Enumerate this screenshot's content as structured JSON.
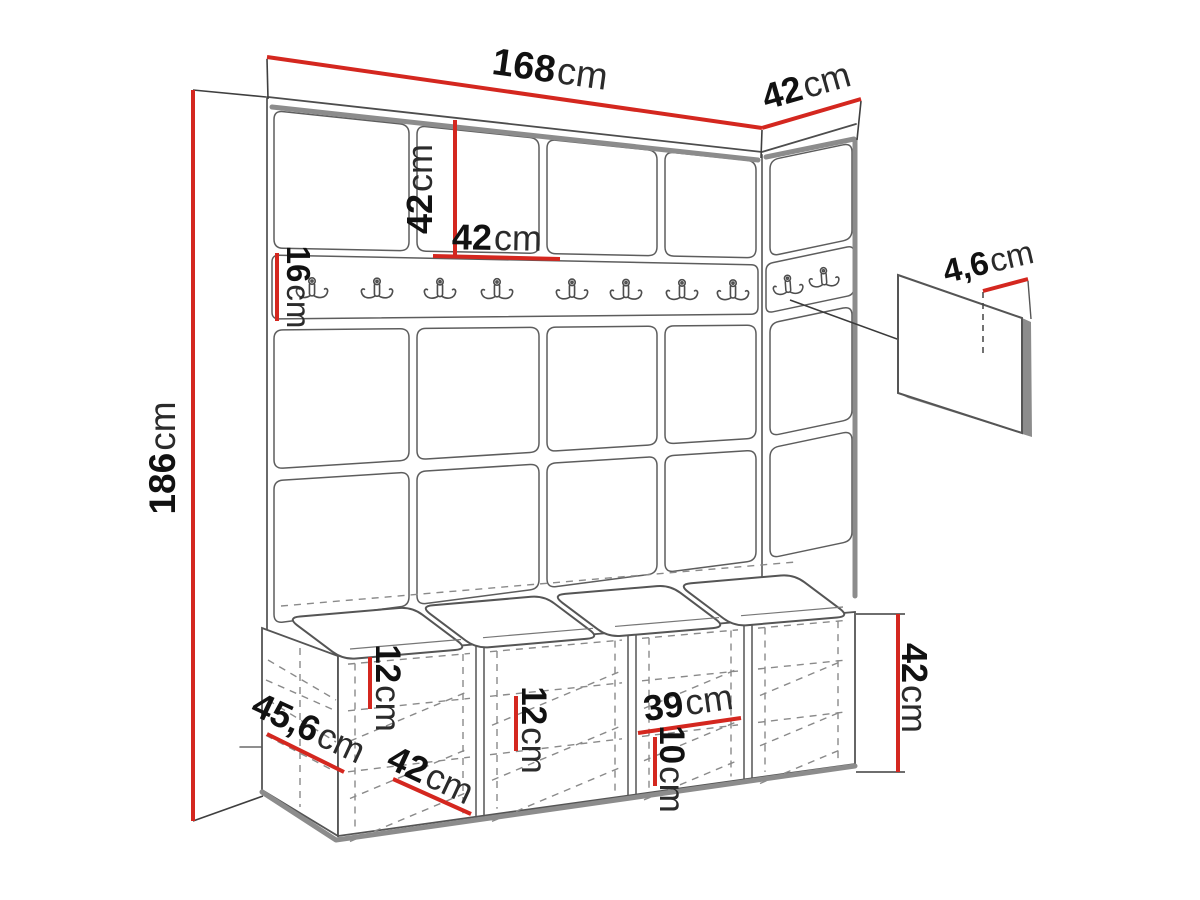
{
  "diagram": {
    "description": "Hallway wardrobe set dimension drawing: upholstered wall panels with coat-hook rail, hook detail panel and shoe storage bench with seat cushions",
    "unit": "cm"
  },
  "dimensions": {
    "total_width": {
      "value": "168",
      "unit": "cm"
    },
    "side_panel_width": {
      "value": "42",
      "unit": "cm"
    },
    "panel_height": {
      "value": "42",
      "unit": "cm"
    },
    "panel_width": {
      "value": "42",
      "unit": "cm"
    },
    "hook_rail_height": {
      "value": "16",
      "unit": "cm"
    },
    "total_height": {
      "value": "186",
      "unit": "cm"
    },
    "hook_panel_offset": {
      "value": "4,6",
      "unit": "cm"
    },
    "bench_shelf_gap_top": {
      "value": "12",
      "unit": "cm"
    },
    "bench_shelf_gap_middle": {
      "value": "12",
      "unit": "cm"
    },
    "bench_compartment_width": {
      "value": "39",
      "unit": "cm"
    },
    "bench_shelf_gap_bottom": {
      "value": "10",
      "unit": "cm"
    },
    "bench_depth": {
      "value": "45,6",
      "unit": "cm"
    },
    "bench_section_width": {
      "value": "42",
      "unit": "cm"
    },
    "bench_height": {
      "value": "42",
      "unit": "cm"
    }
  },
  "counts": {
    "front_rail_hooks": 8,
    "side_rail_hooks": 2,
    "detail_panel_hooks": 2,
    "bench_cushions": 4,
    "bench_compartments": 4,
    "wall_panel_columns": 4,
    "side_panel_columns": 1
  },
  "icons": {
    "coat_hook": "double-prong-coat-hook"
  },
  "colors": {
    "dimension_line": "#d4271f",
    "outline": "#4d4d4d",
    "edge_shadow": "#8c8c8c",
    "text": "#111111",
    "background": "#ffffff"
  }
}
